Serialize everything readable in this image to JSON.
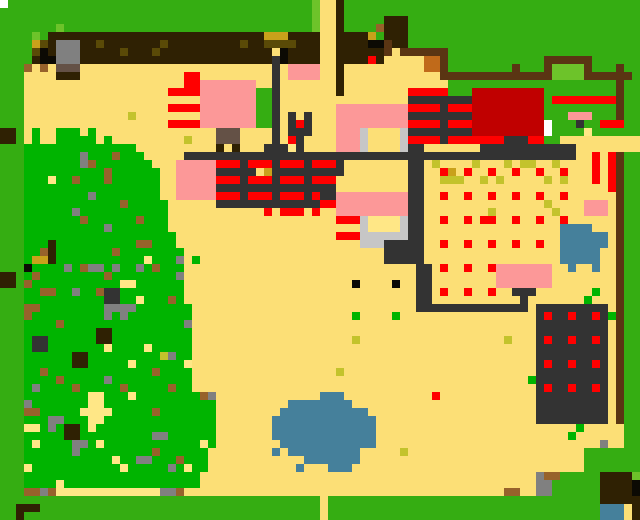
{
  "map": {
    "cell_size": 8,
    "cols": 80,
    "rows": 65,
    "width_px": 640,
    "height_px": 520,
    "palette": {
      "G": "#35AD12",
      "L": "#6DC32A",
      "F": "#00B400",
      "T": "#FCDF76",
      "h": "#FFE786",
      "Y": "#C3C32C",
      "M": "#C9A11B",
      "X": "#C06A1A",
      "O": "#5A4A07",
      "D": "#2F2103",
      "b": "#5A3513",
      "B": "#97622B",
      "s": "#645146",
      "g": "#808080",
      "C": "#C6C6C6",
      "K": "#333333",
      "k": "#0C0A04",
      "R": "#FF0000",
      "r": "#C00000",
      "P": "#FC9898",
      "W": "#FFFFFF",
      "A": "#45809B"
    },
    "palette_legend": {
      "G": "border-grass-green",
      "L": "light-green",
      "F": "forest-green",
      "T": "sand-tan-ground",
      "h": "pale-yellow-path",
      "Y": "yellow-green-speck",
      "M": "mustard",
      "X": "orange",
      "O": "dark-olive",
      "D": "dark-brown",
      "b": "road-brown",
      "B": "dirt-brown",
      "s": "gray-brown",
      "g": "stone-gray",
      "C": "light-gray",
      "K": "dark-gray-path",
      "k": "black",
      "R": "bright-red",
      "r": "dark-red-building",
      "P": "pink-building",
      "W": "white",
      "A": "water-blue"
    },
    "rows_rle": [
      "W1G38L1T2D1G37",
      "G39L1T2D1G37",
      "G39L1T2D1G5D3G29",
      "G7L1G31L1T2D1G4B1D3G29",
      "G4L1G1D27M3D4T2D4M1G1D3G29",
      "G4M1O1D1g3D2O1D7O1D9O1D2O4D3T2D4k2b1D2G29",
      "G4O1k1D1g3D5O1D3O1D14T1k1D4T2D6b1T1b6G24",
      "G4D1k2g3D24K1k1D4T2D4R1D1T5X2b1G12b6G6",
      "G3B1T1B1T1s3T24K1T1P4T2D1T10X2b1G8b1G3b1L4b1G3b1G2",
      "G3T4D3T13R2T9K1T1P4T2D1T12b14L4b6G1",
      "G3T20R2P7T2K1T7D1T13G21b1G2",
      "G3T18R4P7G2K1T7D1T8R5G3r9G9b1G2",
      "G3T22P7G2K1T16K8r9G1R8b1G2",
      "G3T18R4P7G2K1T7P9R4K1R3r9G9b1G2",
      "G3T13Y1T8P7G2K1T1K1T1K1T3P9K8r9G3P3G3b1G2",
      "G3T18R4P7G2K1T1K1R1K1T3P9R4K1R3r9W1G3K1G2R3G2",
      "D2G1T1F1T2F3T1F1T15s3T4K1T1K3T3P3C1T4C1K8r9W1G4h1G6",
      "D2G1T1F1T2F5T1F1T9Y1T3s3T4K1T1R1K1T4P3C1T4C1R4K1R7K3R2G2T10",
      "G3F14T10D1T1D1T3K3h1K1T4P3C1T4C1K2T7K12T8",
      "G3F7g1F3B1F3T5K49T2R1T1R1b1G2",
      "G3F7g1B1F7T3P5R3K1R3K1R3K1R3K1T8K2T1Y1T4Y1T3Y1T1Y2T2Y1T4R1T1R1b1G2",
      "G3F10B1F6T2P5K5T1M1K9T8K2T2R1M1T1R1T2R1T2R1T2R1T2R1T3R1T1R1b1G2",
      "G3F3h1F2B1F3B1F6T2P5R3K1R3K1R3K1R3T9K2T2Y3T2Y1T1Y1T5Y1T1Y1T3R1T1R1b1G2",
      "G3F17T2P5K15T9K2T23R1b1G2",
      "G3F8g1F8T2P5R3K1R3K1R3K1R1K2P9K2T2R1T2R1T2R1T2R1T2R1T2R1T6b1G2",
      "G3F12B1F5T6K13R2P9K2T15Y1T4P3T1b1G2",
      "G3F6g1F11T12R1T1R3T1R1T2P9K2T8Y1T7Y1T3P3T1b1G2",
      "G3F7B1F6B1F3T21R3C1h4C1K2T2R1T2R1T1R2T2R1T2R1T2R1T6b1G2",
      "G3F10g1F7T24C1h4C1K2T17A4T3b1G2",
      "G3F19T20R3C6K2T17A6T1b1G2",
      "G3F3D1F10B2F3T23C3K5T2R1T2R1T2R1T2R1T2R1T2A6T1b1G2",
      "G3F2B1D1F7B1F8T25K5T17A5T2b1G2",
      "G3F1M2D1F11h1F3g1T1F1T23K5T17A5T2b1G2",
      "G3k1F4g1F1B1g2F1g1F2g1F1B1F3T29K2T1R1T2R1T2R1P7T2A1T2A1T2b1G2",
      "D2G1F1B1F8B1F8g1T29K2T8P7T8b1G2",
      "D2G1B1F11h2F6T21k1T4k1T2K2T8P7T8b1G2",
      "G3F2B2F2g1F2B1K2F8T29K2T1R1T2R1T2R1T2K3T7F1T2b1G2",
      "G3F10K2F2h1F3B1F1T29K2T11K1T7F1T3b1G2",
      "G3B2F8g4F7T28K14T1K9T1b1G2",
      "G3B1F9g1F1g1F8T20F1T4F1T17K1R1K2R1K2R1K1F1b1G2",
      "G3F4B1F15g1T43K9T1b1G2",
      "G3F9D2F10T43K9T1b1G2",
      "G3F1K2F6D2F10T20Y1T18Y1T3K1R1K2R1K2R1K1T1b1G2",
      "G3F1K2F7h1F4h1F5T43K9T1b1G2",
      "G3F6D2F9Y1g1F2T43K9T1b1G2",
      "G3F6D2F5h1F6h1T43K1R1K2R1K2R1K1T1b1G2",
      "G3F2B1F13B1F4T18Y1T24K9T1b1G2",
      "G3F4B1F5g1F10T42F1K9T1b1G2",
      "G3F1g1F4B1F5B1F5B1F2T43K1R1K2R1K2R1K1T1b1G2",
      "G3F8h2F3h1F8B1g1T13A3T11R1T12K9T1b1G2",
      "G3g1F7h2F14T9A8T23K9T1b1G2",
      "G3B2F5h4F5B1F7T8A11T21K9T1b1G2",
      "G3F3g2F3h2F14T7A13T20K9T1b1G2",
      "G3h2F1g1F1D2F1h1F15T7A13T25F1T5G2",
      "G3F5D2F9g2F6T7A13T24F1T6G2",
      "G3F1h1F4g2F1h1F12h1F1T8A12T28g1T2G2",
      "G3F6g1F9B1F6T8A1T1A9T5Y1T22G7",
      "G3F11h1F2g2F3B1F3T12A7T28G7",
      "G3h1F11h1F5g1F1h1F2T11A1T3A3T29G7",
      "G3F22T42g1B2G5D4L1",
      "G3F4h1F17T42g2G6D4k1",
      "G3B2g1B1h13g2B1T40B2T2g2G6D4k1",
      "G40T1G34D5",
      "G2D3G35T1G34A3T1D1",
      "G2D1G37T1G34A3T1D1"
    ]
  }
}
